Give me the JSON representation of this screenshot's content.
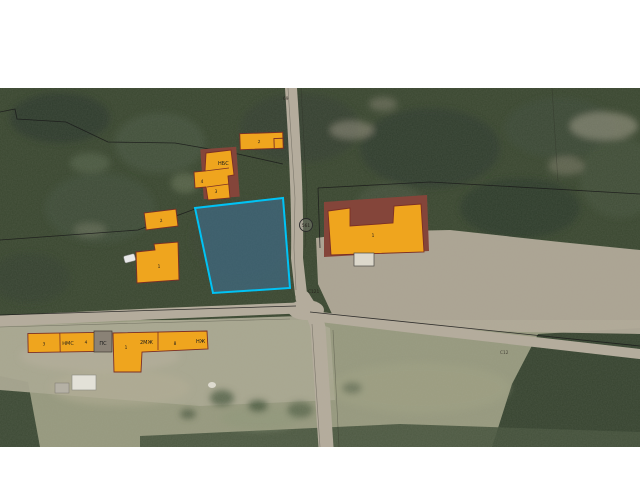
{
  "map": {
    "labels": {
      "road_number": "561",
      "street_code_1": "С121",
      "street_code_2": "С12",
      "boundary_point": "69"
    },
    "buildings": {
      "top_small_num": "2",
      "cluster_type": "НБС",
      "cluster_num_main": "3",
      "cluster_num_annex": "4",
      "left_small_num": "2",
      "left_lower_num": "1",
      "big_num": "1",
      "row_a_num1": "3",
      "row_a_type": "НМС",
      "row_a_num2": "4",
      "substation_type": "ПС",
      "row_b_num1": "1",
      "row_b_type1": "2МЖ",
      "row_b_num2": "8",
      "row_b_type2": "НЖ"
    },
    "colors": {
      "building_fill": "#EFA51E",
      "building_stroke": "#7B2F26",
      "selected_parcel_fill": "#3F6E8E",
      "selected_parcel_stroke": "#00C3F5",
      "boundary_line": "#1A1A1A",
      "road": "#B5AC9C"
    }
  }
}
